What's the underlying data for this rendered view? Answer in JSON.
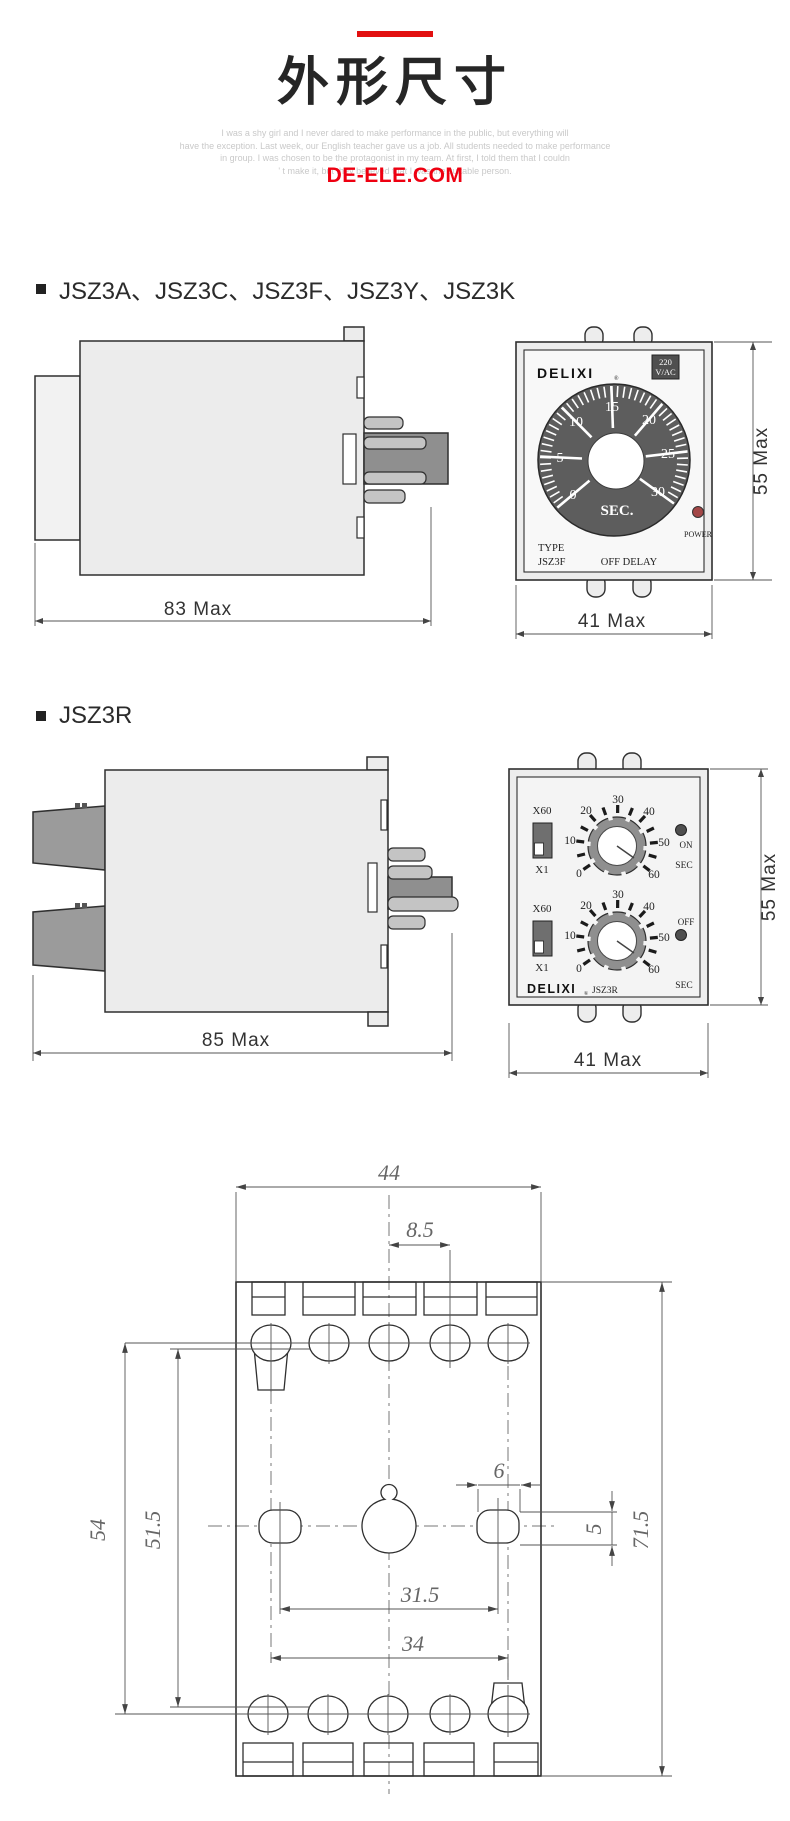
{
  "page": {
    "title": "外形尺寸",
    "site": "DE-ELE.COM",
    "watermark": [
      "I was a shy girl and I never dared to make performance in the public, but everything will",
      "have the exception. Last week, our English teacher gave us a job. All students needed to make performance",
      "in group. I was chosen to be the protagonist in my team. At first, I told them that I couldn",
      "' t make it, but they believed that I was the suitable person."
    ]
  },
  "sections": [
    {
      "heading": "JSZ3A、JSZ3C、JSZ3F、JSZ3Y、JSZ3K"
    },
    {
      "heading": "JSZ3R"
    }
  ],
  "relay1": {
    "front": {
      "brand": "DELIXI",
      "reg": "®",
      "voltage": [
        "220",
        "V/AC"
      ],
      "dial": [
        "0",
        "5",
        "10",
        "15",
        "20",
        "25",
        "30"
      ],
      "unit": "SEC.",
      "type_label": "TYPE",
      "model": "JSZ3F",
      "mode": "OFF DELAY",
      "power_label": "POWER"
    },
    "dims": {
      "depth": "83 Max",
      "height": "55 Max",
      "width": "41 Max"
    }
  },
  "relay2": {
    "front": {
      "brand": "DELIXI",
      "reg": "®",
      "model": "JSZ3R",
      "range_high": "X60",
      "range_low": "X1",
      "dial": [
        "0",
        "10",
        "20",
        "30",
        "40",
        "50",
        "60"
      ],
      "on": "ON",
      "off": "OFF",
      "unit": "SEC"
    },
    "dims": {
      "depth": "85 Max",
      "height": "55 Max",
      "width": "41 Max"
    }
  },
  "footprint": {
    "overall_width": "44",
    "slot_pitch": "8.5",
    "hole_width": "6",
    "hole_height": "5",
    "row_span_outer": "54",
    "row_span_inner": "51.5",
    "hole_span_inner": "31.5",
    "hole_span_outer": "34",
    "overall_height": "71.5"
  },
  "colors": {
    "accent_red": "#e21010",
    "site_red": "#ee0011",
    "dial_ring": "#5d5d5d"
  }
}
